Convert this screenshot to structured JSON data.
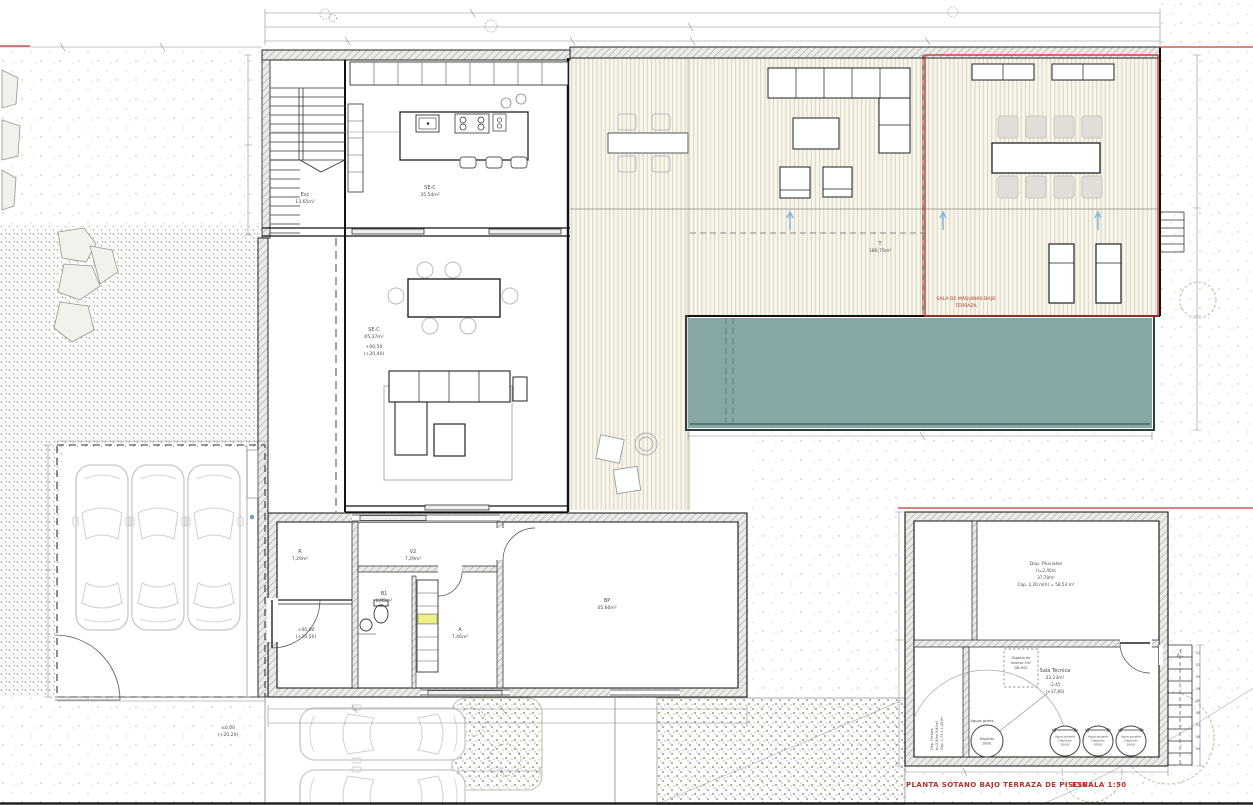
{
  "title_block": {
    "title": "PLANTA SÓTANO BAJO TERRAZA DE PISCINA",
    "scale": "ESCALA 1:50"
  },
  "colors": {
    "pool_water": "#86a7a4",
    "deck_wood": "#f8f6ec",
    "annotation_red": "#b5342c",
    "vegetation_green": "#6f7f53",
    "highlight_yellow": "#eef08a",
    "water_arrow_blue": "#85b8d8"
  },
  "main_plan": {
    "stairs": {
      "label": "Esc",
      "area": "13,65m²"
    },
    "kitchen": {
      "label": "SE-C",
      "area": "35,54m²"
    },
    "living": {
      "label": "SE-C",
      "area": "65,37m²",
      "level": "+00,50",
      "level_abs": "(+20,40)"
    },
    "terrace": {
      "label": "T",
      "area": "180,75m²"
    },
    "machine_room": {
      "line1": "SALA DE MÁQUINAS BAJO",
      "line2": "TERRAZA"
    },
    "room_r": {
      "label": "R",
      "area": "7,29m²"
    },
    "room_v2": {
      "label": "V2",
      "area": "7,29m²"
    },
    "room_b1": {
      "label": "B1",
      "area": "6,85m²"
    },
    "room_a": {
      "label": "A",
      "area": "7,46m²"
    },
    "room_bp": {
      "label": "BP",
      "area": "45,60m²"
    },
    "entry_level": {
      "rel": "+00,00",
      "abs": "(+20,50)"
    },
    "site_level": {
      "rel": "±0,00",
      "abs": "(+20,20)"
    }
  },
  "basement_plan": {
    "dep_pluviales": {
      "line1": "Dep. Pluviales",
      "line2": "h=2,40m",
      "line3": "37,70m²",
      "line4": "Cap. 2,20 m(h) = 58,53 m³"
    },
    "sala_tecnica": {
      "line1": "Sala Técnica",
      "line2": "22,23m²",
      "line3": "-2,45",
      "line4": "(+17,85)"
    },
    "reserva": {
      "line1": "Espacio de",
      "line2": "reserva 1m²",
      "line3": "DB-HS2"
    },
    "dep_fecales": {
      "line1": "Dep. Fecales",
      "line2": "h=2,40m  5,80m²",
      "line3": "Cap. 1,73 x 1,43 m³"
    },
    "aguas_grises_label": "Aguas grises",
    "tank_grises": {
      "line1": "Depósito",
      "line2": "1000L"
    },
    "tank_potable": {
      "line1": "Agua potable",
      "line2": "Depósito",
      "line3": "1000L"
    },
    "stair_steps": [
      "01",
      "02",
      "03",
      "04",
      "05",
      "06",
      "07",
      "08",
      "09"
    ]
  }
}
